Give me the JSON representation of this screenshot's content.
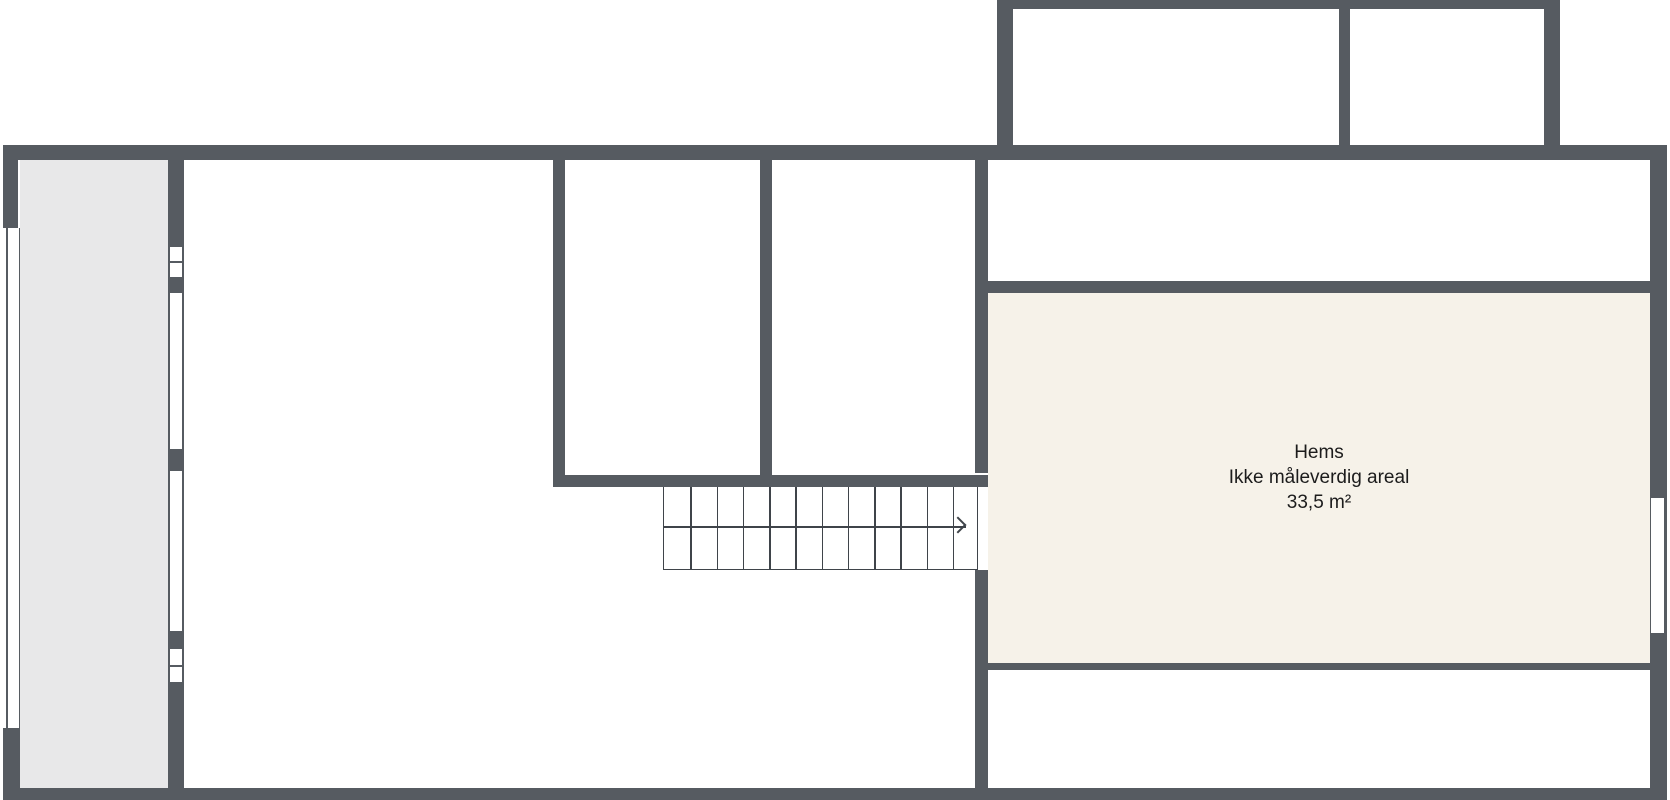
{
  "plan": {
    "kind": "floor-plan",
    "room_label": {
      "name": "Hems",
      "note": "Ikke måleverdig areal",
      "area": "33,5 m²"
    },
    "stairs": {
      "treads": 12,
      "direction_arrow": "right"
    }
  },
  "colors": {
    "bg": "#ffffff",
    "wall": "#565b61",
    "room-gray": "#e8e8e9",
    "room-cream": "#f6f2e9",
    "line": "#3f444a",
    "text": "#1c1c1c"
  }
}
